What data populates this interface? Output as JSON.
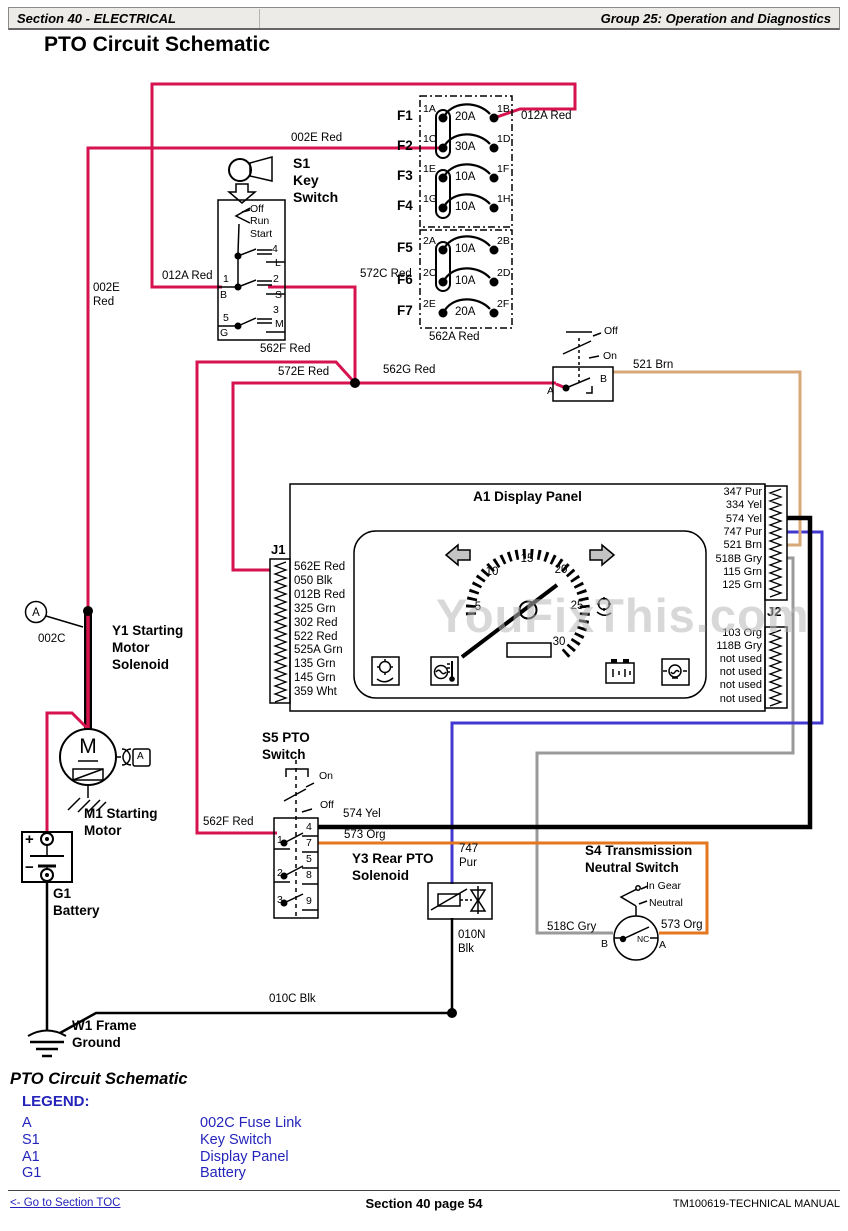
{
  "header": {
    "left": "Section 40 - ELECTRICAL",
    "right": "Group 25: Operation and Diagnostics"
  },
  "page_title": "PTO Circuit Schematic",
  "watermark": "YouFixThis.com",
  "fuses": {
    "rows": [
      {
        "f": "F1",
        "in": "1A",
        "amps": "20A",
        "out": "1B"
      },
      {
        "f": "F2",
        "in": "1C",
        "amps": "30A",
        "out": "1D"
      },
      {
        "f": "F3",
        "in": "1E",
        "amps": "10A",
        "out": "1F"
      },
      {
        "f": "F4",
        "in": "1G",
        "amps": "10A",
        "out": "1H"
      },
      {
        "f": "F5",
        "in": "2A",
        "amps": "10A",
        "out": "2B"
      },
      {
        "f": "F6",
        "in": "2C",
        "amps": "10A",
        "out": "2D"
      },
      {
        "f": "F7",
        "in": "2E",
        "amps": "20A",
        "out": "2F"
      }
    ],
    "feed_label": "562A Red"
  },
  "wire_labels": {
    "w012a_top": "012A Red",
    "w002e_top": "002E Red",
    "w012a": "012A Red",
    "w002e_v1": "002E",
    "w002e_v2": "Red",
    "w572c": "572C Red",
    "w562f": "562F Red",
    "w572e": "572E Red",
    "w562g": "562G Red",
    "w521": "521 Brn",
    "w562f2": "562F Red",
    "w574": "574 Yel",
    "w573": "573 Org",
    "w747_1": "747",
    "w747_2": "Pur",
    "w010n_1": "010N",
    "w010n_2": "Blk",
    "w518c": "518C Gry",
    "w573b": "573 Org",
    "w010c": "010C Blk",
    "w002c": "002C"
  },
  "key_switch": {
    "id": "S1",
    "name_1": "Key",
    "name_2": "Switch",
    "pos": [
      "Off",
      "Run",
      "Start"
    ],
    "pins": {
      "p4": "4",
      "l": "L",
      "p1": "1",
      "b": "B",
      "p2": "2",
      "s": "S",
      "p5": "5",
      "g": "G",
      "p3": "3",
      "m": "M"
    }
  },
  "light_switch": {
    "off": "Off",
    "on": "On",
    "a": "A",
    "b": "B"
  },
  "panel": {
    "title": "A1 Display Panel",
    "j1": "J1",
    "j2": "J2",
    "j1_pins": [
      "562E Red",
      "050 Blk",
      "012B Red",
      "325 Grn",
      "302 Red",
      "522 Red",
      "525A Grn",
      "135 Grn",
      "145 Grn",
      "359 Wht"
    ],
    "right_pins": [
      "347 Pur",
      "334 Yel",
      "574 Yel",
      "747 Pur",
      "521 Brn",
      "518B Gry",
      "115 Grn",
      "125 Grn"
    ],
    "j2_pins": [
      "103 Org",
      "118B Gry",
      "not used",
      "not used",
      "not used",
      "not used"
    ],
    "gauge": [
      "5",
      "10",
      "15",
      "20",
      "25",
      "30"
    ]
  },
  "s5": {
    "t1": "S5 PTO",
    "t2": "Switch",
    "on": "On",
    "off": "Off",
    "left_pins": [
      "1",
      "2",
      "3"
    ],
    "right_pins": [
      "4",
      "7",
      "5",
      "8",
      "9"
    ]
  },
  "y3": {
    "t1": "Y3 Rear PTO",
    "t2": "Solenoid"
  },
  "s4": {
    "t1": "S4 Transmission",
    "t2": "Neutral Switch",
    "in_gear": "In Gear",
    "neutral": "Neutral",
    "nc": "NC",
    "a": "A",
    "b": "B"
  },
  "y1": {
    "t1": "Y1 Starting",
    "t2": "Motor",
    "t3": "Solenoid",
    "link": "A"
  },
  "m1": {
    "m": "M",
    "t1": "M1 Starting",
    "t2": "Motor",
    "plug": "A"
  },
  "g1": {
    "t1": "G1",
    "t2": "Battery",
    "plus": "+",
    "minus": "−"
  },
  "w1": {
    "t1": "W1 Frame",
    "t2": "Ground"
  },
  "caption": "PTO Circuit Schematic",
  "legend": {
    "heading": "LEGEND:",
    "rows": [
      {
        "k": "A",
        "v": "002C Fuse Link"
      },
      {
        "k": "S1",
        "v": "Key Switch"
      },
      {
        "k": "A1",
        "v": "Display Panel"
      },
      {
        "k": "G1",
        "v": "Battery"
      }
    ]
  },
  "footer": {
    "toc": "<- Go to Section TOC",
    "page": "Section 40 page 54",
    "manual": "TM100619-TECHNICAL MANUAL"
  },
  "colors": {
    "red": "#d6134f",
    "tan": "#d9a878",
    "orange": "#e4761f",
    "blue": "#4238d0",
    "gray": "#9a9a9a",
    "legend_blue": "#2424bb"
  }
}
